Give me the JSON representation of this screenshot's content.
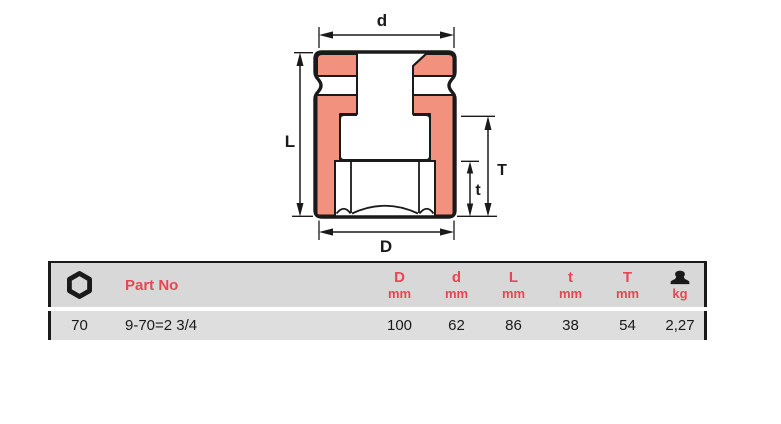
{
  "diagram": {
    "type": "impact-socket-cross-section",
    "fill_color": "#F3917F",
    "line_color": "#1A1A1A",
    "labels": {
      "d": "d",
      "L": "L",
      "D": "D",
      "T": "T",
      "t": "t"
    }
  },
  "table": {
    "accent_color": "#E84653",
    "header": {
      "size_icon": "hex-socket-icon",
      "part_no_label": "Part No",
      "columns": [
        {
          "dim": "D",
          "unit": "mm"
        },
        {
          "dim": "d",
          "unit": "mm"
        },
        {
          "dim": "L",
          "unit": "mm"
        },
        {
          "dim": "t",
          "unit": "mm"
        },
        {
          "dim": "T",
          "unit": "mm"
        }
      ],
      "weight_icon": "weight-icon",
      "weight_unit": "kg"
    },
    "row": {
      "size": "70",
      "part_no": "9-70=2 3/4",
      "values": [
        "100",
        "62",
        "86",
        "38",
        "54"
      ],
      "weight": "2,27"
    }
  }
}
